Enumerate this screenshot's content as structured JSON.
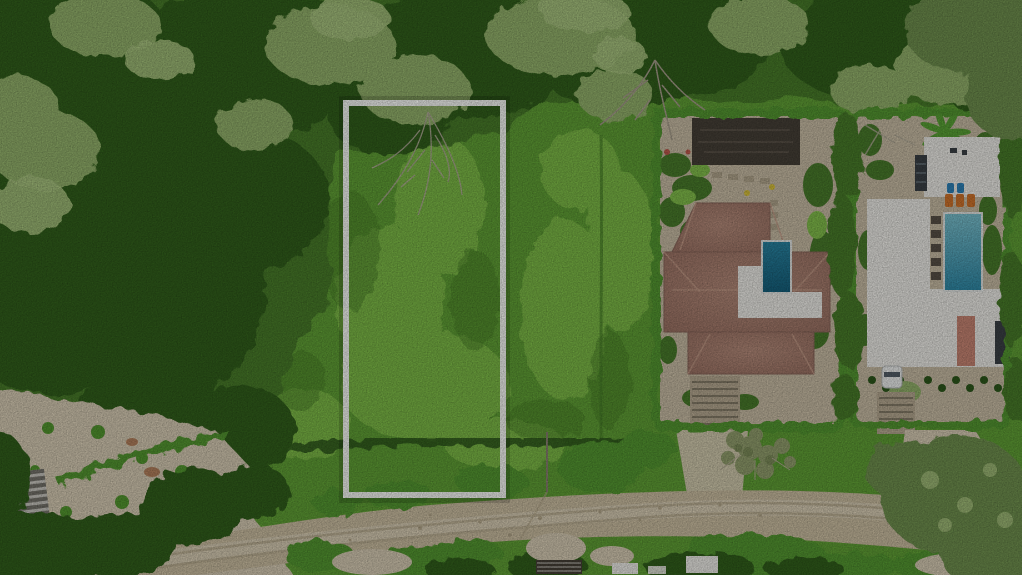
{
  "photo": {
    "type": "aerial-drone-photograph",
    "description": "Aerial drone view of a vacant land parcel outlined in white, bordered by dense forest on the left, a bright green meadow, two hedge-enclosed homes with swimming pools on the right, and a sandy dirt road across the bottom."
  },
  "annotation": {
    "label": "lot-boundary",
    "shape": "rectangle",
    "x": 346,
    "y": 103,
    "width": 157,
    "height": 392,
    "stroke": "#ffffff",
    "stroke_width": 6,
    "shadow": "rgba(0,0,0,0.16)"
  },
  "palette": {
    "meadow": "#61a136",
    "meadow_light": "#83c04c",
    "meadow_dark": "#477f28",
    "forest_dark": "#33601f",
    "forest_mid": "#4a7d2c",
    "canopy_pale": "#94b36c",
    "canopy_light": "#aac580",
    "olive": "#6f9150",
    "hedge": "#549930",
    "hedge_dark": "#2e591c",
    "ground_tan": "#cabea6",
    "sand": "#d8cdb5",
    "road": "#ccbfa2",
    "road_light": "#ddd3bb",
    "road_track": "#b5a88b",
    "roof_hi": "#b68c7b",
    "roof_lo": "#9a7163",
    "roof_ridge": "#c59d89",
    "roof_edge": "#8c685c",
    "roof_white": "#efeee9",
    "roof_white_shadow": "#cfcdc6",
    "roof_dark": "#474138",
    "carport_streak": "#6d6459",
    "roof_salmon": "#c98674",
    "slate": "#3c4247",
    "pool1_hi": "#2a85a3",
    "pool1_lo": "#15607c",
    "pool2_hi": "#7cc2cf",
    "pool2_lo": "#2f8aa8",
    "pool_coping": "#e5e8e6",
    "lounger_orange": "#d2752c",
    "lounger_blue": "#2f84bb",
    "car": "#eef0ef",
    "car_glass": "#55606a",
    "banana": "#5aa336",
    "dead_branch": "#b3ac9a",
    "bare_tree": "#a89f8d",
    "dry_bush": "#93a06e",
    "dry_bush_dark": "#7e8e5b",
    "twig": "#b7ae97",
    "pergola_light": "#c9c7c0",
    "pergola_dark": "#77756d",
    "steps": "#b8ab93",
    "step_line": "#877e6a",
    "paver": "#b3a78e",
    "paver_dark": "#5a5248",
    "flower_red": "#bf5a4e",
    "flower_yellow": "#d9c23c",
    "dirt_brown": "#b0764f",
    "left_roof": "#8d5f4a",
    "left_teal": "#3f8e86"
  }
}
